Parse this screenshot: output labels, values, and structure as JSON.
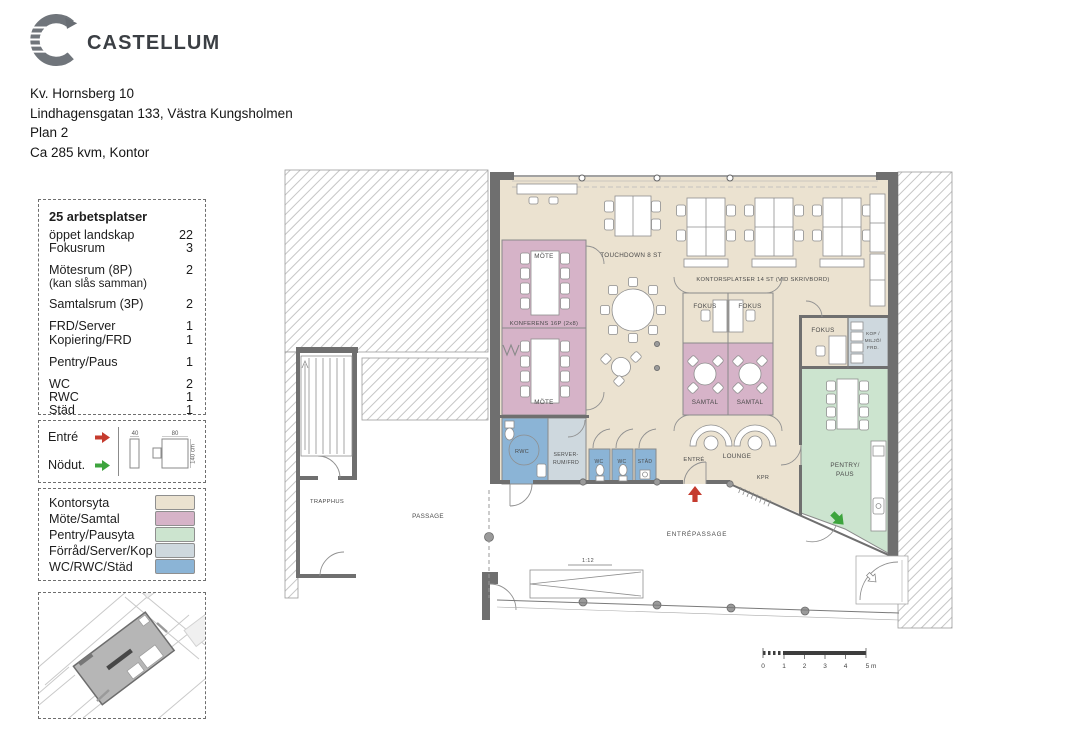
{
  "header": {
    "brand": "CASTELLUM",
    "address_lines": [
      "Kv. Hornsberg 10",
      "Lindhagensgatan 133, Västra Kungsholmen",
      "Plan 2",
      "Ca 285 kvm, Kontor"
    ]
  },
  "summary": {
    "title": "25 arbetsplatser",
    "rows": [
      {
        "label": "öppet landskap",
        "count": "22"
      },
      {
        "label": "Fokusrum",
        "count": "3"
      },
      {
        "label": "Mötesrum (8P)",
        "count": "2",
        "note": "(kan slås samman)"
      },
      {
        "label": "Samtalsrum (3P)",
        "count": "2"
      },
      {
        "label": "FRD/Server",
        "count": "1"
      },
      {
        "label": "Kopiering/FRD",
        "count": "1"
      },
      {
        "label": "Pentry/Paus",
        "count": "1"
      },
      {
        "label": "WC",
        "count": "2"
      },
      {
        "label": "RWC",
        "count": "1"
      },
      {
        "label": "Städ",
        "count": "1"
      }
    ]
  },
  "access": {
    "items": [
      {
        "label": "Entré",
        "color": "#c53b2e"
      },
      {
        "label": "Nödut.",
        "color": "#3da43d"
      }
    ],
    "dims": {
      "cabinet": "40",
      "desk": "80",
      "depth": "140 cm"
    }
  },
  "legend": {
    "items": [
      {
        "label": "Kontorsyta",
        "color": "#ebe2d0"
      },
      {
        "label": "Möte/Samtal",
        "color": "#d6b3c8"
      },
      {
        "label": "Pentry/Pausyta",
        "color": "#cce4cf"
      },
      {
        "label": "Förråd/Server/Kop",
        "color": "#ced8de"
      },
      {
        "label": "WC/RWC/Städ",
        "color": "#8bb4d6"
      }
    ]
  },
  "plan": {
    "labels": {
      "mote_top": "MÖTE",
      "konferens": "KONFERENS 16P (2x8)",
      "mote_bottom": "MÖTE",
      "touchdown": "TOUCHDOWN 8 ST",
      "kontorsplatser": "KONTORSPLATSER 14 ST (VID SKRIVBORD)",
      "fokus": "FOKUS",
      "samtal": "SAMTAL",
      "kop_line1": "KOP /",
      "kop_line2": "MILJÖ/",
      "kop_line3": "FRD.",
      "rwc": "RWC",
      "server_line1": "SERVER-",
      "server_line2": "RUM/FRD",
      "wc": "WC",
      "stad": "STÄD",
      "entre": "ENTRÉ",
      "lounge": "LOUNGE",
      "kpr": "KPR",
      "pentry_line1": "PENTRY/",
      "pentry_line2": "PAUS",
      "trapphus": "TRAPPHUS",
      "passage": "PASSAGE",
      "entrepassage": "ENTRÉPASSAGE",
      "ramp": "1:12"
    },
    "scale_ticks": [
      "0",
      "1",
      "2",
      "3",
      "4",
      "5 m"
    ]
  }
}
